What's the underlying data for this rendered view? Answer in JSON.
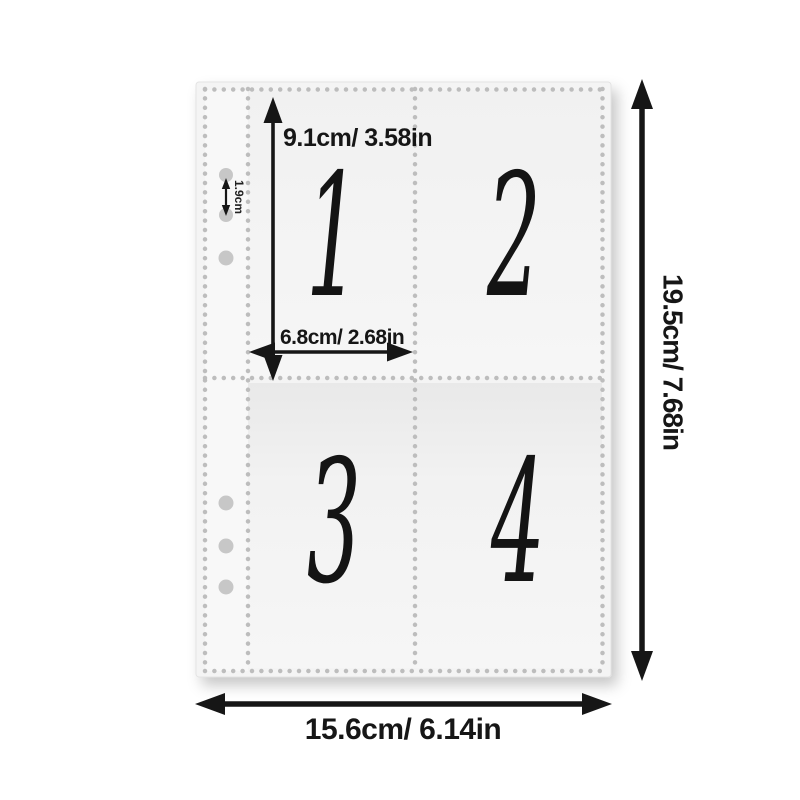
{
  "diagram": {
    "sleeve": {
      "pocket_numbers": [
        "1",
        "2",
        "3",
        "4"
      ],
      "hole_count": 6
    },
    "dimensions": {
      "pocket_height": "9.1cm/ 3.58in",
      "pocket_width": "6.8cm/ 2.68in",
      "hole_spacing": "1.9cm",
      "page_height": "19.5cm/ 7.68in",
      "page_width": "15.6cm/ 6.14in"
    },
    "colors": {
      "background": "#ffffff",
      "sleeve": "#f3f3f3",
      "stitch_dots": "#bdbdbd",
      "binder_holes": "#c7c7c7",
      "ink": "#161616"
    }
  }
}
